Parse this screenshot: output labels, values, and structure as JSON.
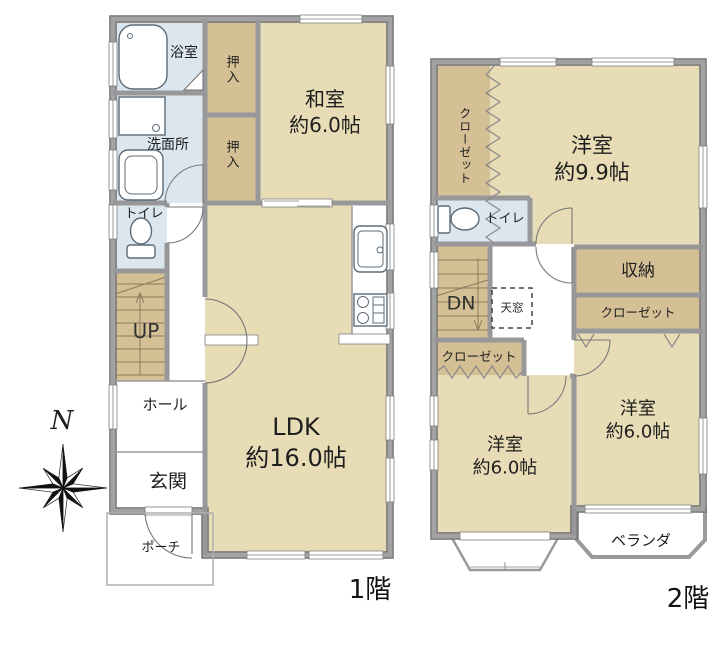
{
  "plan": {
    "type": "floor-plan",
    "compass": {
      "north": "N"
    },
    "colors": {
      "room_tan": "#e8dcb6",
      "closet_tan": "#d5c096",
      "wet_blue": "#dbe6ef",
      "wall_gray": "#98989a",
      "text": "#1e1e1e"
    },
    "floor1": {
      "label": "1階",
      "rooms": {
        "bath": "浴室",
        "washroom": "洗面所",
        "toilet": "トイレ",
        "stairs": "UP",
        "hall": "ホール",
        "entrance": "玄関",
        "porch": "ポーチ",
        "closet_top": "押入",
        "closet_bottom": "押入",
        "washitsu": {
          "name": "和室",
          "size": "約6.0帖"
        },
        "ldk": {
          "name": "LDK",
          "size": "約16.0帖"
        }
      }
    },
    "floor2": {
      "label": "2階",
      "rooms": {
        "closet_tall": "クローゼット",
        "western_main": {
          "name": "洋室",
          "size": "約9.9帖"
        },
        "toilet": "トイレ",
        "stairs": "DN",
        "skylight": "天窓",
        "storage": "収納",
        "closet_right": "クローゼット",
        "closet_left": "クローゼット",
        "western_left": {
          "name": "洋室",
          "size": "約6.0帖"
        },
        "western_right": {
          "name": "洋室",
          "size": "約6.0帖"
        },
        "veranda": "ベランダ"
      }
    }
  }
}
